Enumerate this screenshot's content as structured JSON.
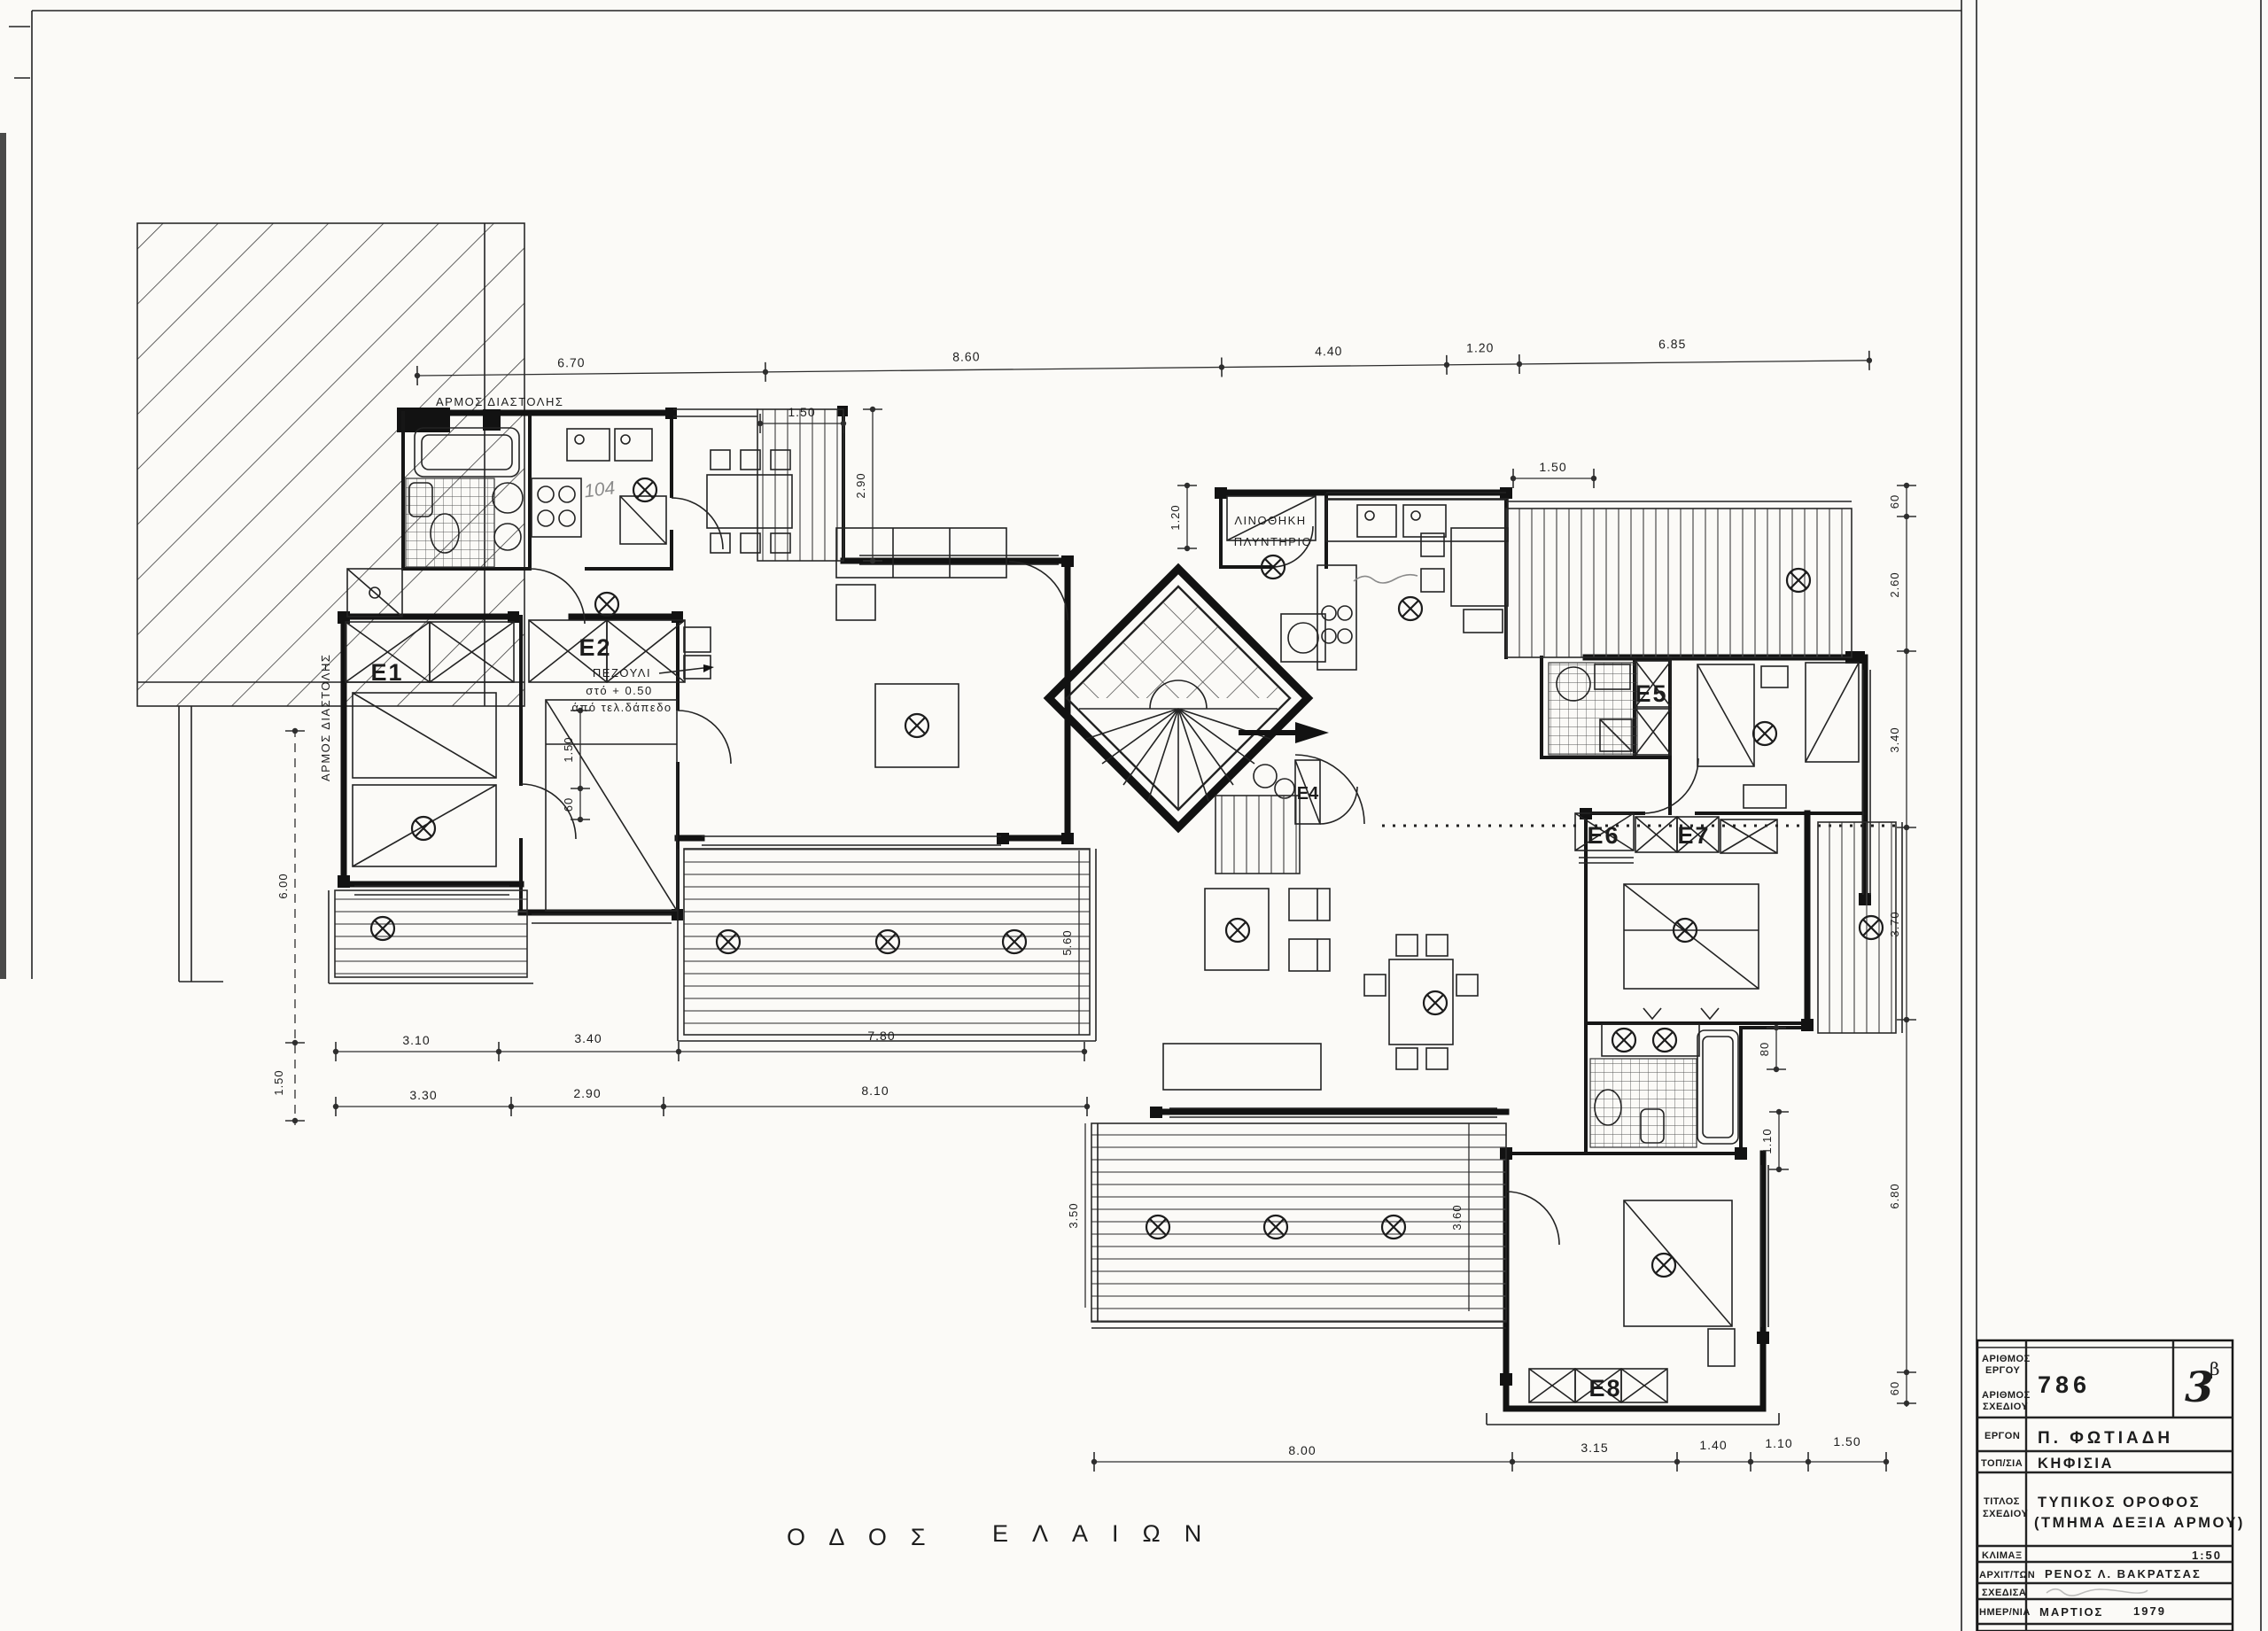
{
  "street": {
    "word1": "ΟΔΟΣ",
    "word2": "ΕΛΑΙΩΝ"
  },
  "annotations": {
    "joint_top": "ΑΡΜΟΣ ΔΙΑΣΤΟΛΗΣ",
    "joint_left": "ΑΡΜΟΣ ΔΙΑΣΤΟΛΗΣ",
    "linen": "ΛΙΝΟΘΗΚΗ",
    "laundry": "ΠΛΥΝΤΗΡΙΟ",
    "ledge_line1": "ΠΕΖΟΥΛΙ",
    "ledge_line2": "στό + 0.50",
    "ledge_line3": "άπό τελ.δάπεδο",
    "handwritten_note": "104"
  },
  "rooms": {
    "e1": "E1",
    "e2": "E2",
    "e4": "E4",
    "e5": "E5",
    "e6": "E6",
    "e7": "E7",
    "e8": "E8"
  },
  "dimensions": {
    "top": [
      "6.70",
      "8.60",
      "4.40",
      "1.20",
      "6.85"
    ],
    "top_sub": [
      "1.50",
      "1.50"
    ],
    "left": [
      "6.00",
      "1.50"
    ],
    "right": [
      "60",
      "2.60",
      "3.40",
      "3.70",
      "6.80",
      "60"
    ],
    "bottom_left_row1": [
      "3.10",
      "3.40",
      "7.80"
    ],
    "bottom_left_row2": [
      "3.30",
      "2.90",
      "8.10"
    ],
    "bottom_right": [
      "8.00",
      "3.15",
      "1.40",
      "1.10",
      "1.50"
    ],
    "misc": [
      "2.90",
      "1.20",
      "1.50",
      "60",
      "5.60",
      "3.50",
      "3.60",
      "80",
      "1.10"
    ]
  },
  "titleblock": {
    "labels": {
      "project_no_line1": "ΑΡΙΘΜΟΣ",
      "project_no_line2": "ΕΡΓΟΥ",
      "drawing_no_line1": "ΑΡΙΘΜΟΣ",
      "drawing_no_line2": "ΣΧΕΔΙΟΥ",
      "project": "ΕΡΓΟΝ",
      "location": "ΤΟΠ/ΣΙΑ",
      "title_line1": "ΤΙΤΛΟΣ",
      "title_line2": "ΣΧΕΔΙΟΥ",
      "scale": "ΚΛΙΜΑΞ",
      "architect": "ΑΡΧΙΤ/ΤΩΝ",
      "drafter": "ΣΧΕΔΙΣΑ",
      "date": "ΗΜΕΡ/ΝΙΑ"
    },
    "values": {
      "project_no": "786",
      "drawing_no": "3",
      "drawing_no_sup": "β",
      "project": "Π. ΦΩΤΙΑΔΗ",
      "location": "ΚΗΦΙΣΙΑ",
      "title_line1": "ΤΥΠΙΚΟΣ ΟΡΟΦΟΣ",
      "title_line2": "(ΤΜΗΜΑ ΔΕΞΙΑ ΑΡΜΟΥ)",
      "scale": "1:50",
      "architect": "ΡΕΝΟΣ Λ. ΒΑΚΡΑΤΣΑΣ",
      "drafter": "",
      "date_month": "ΜΑΡΤΙΟΣ",
      "date_year": "1979"
    }
  }
}
